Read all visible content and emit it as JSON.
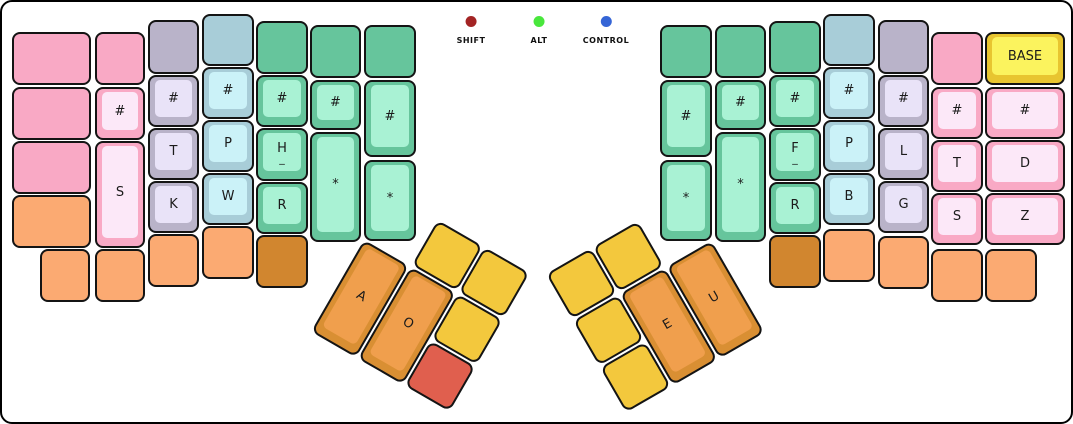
{
  "canvas": {
    "width": 1073,
    "height": 424
  },
  "legend": {
    "indicators": [
      {
        "label": "SHIFT",
        "color": "#a32424",
        "x": 469
      },
      {
        "label": "ALT",
        "color": "#49e73c",
        "x": 537
      },
      {
        "label": "CONTROL",
        "color": "#3565d6",
        "x": 604
      }
    ]
  },
  "palette": {
    "pink": {
      "base": "#f9a9c5",
      "top": "#fce8f8"
    },
    "gray": {
      "base": "#b9b3c9",
      "top": "#e9e3f8"
    },
    "blue": {
      "base": "#a8cdd8",
      "top": "#cbf2f8"
    },
    "green": {
      "base": "#66c59c",
      "top": "#a9f2d4"
    },
    "orange": {
      "base": "#fbaa72",
      "top": "#fbaa72"
    },
    "darkorange": {
      "base": "#d1862f",
      "top": "#d1862f"
    },
    "yellow": {
      "base": "#f3c83d",
      "top": "#f3c83d"
    },
    "red": {
      "base": "#e05f4e",
      "top": "#e05f4e"
    },
    "thumborange": {
      "base": "#d98f33",
      "top": "#f09f4d"
    },
    "basekey": {
      "base": "#e8c530",
      "top": "#fbf35e"
    }
  },
  "main_keys": [
    {
      "x": 10,
      "y": 30,
      "w": 79,
      "h": 53,
      "color": "pink",
      "label": ""
    },
    {
      "x": 10,
      "y": 85,
      "w": 79,
      "h": 53,
      "color": "pink",
      "label": ""
    },
    {
      "x": 10,
      "y": 139,
      "w": 79,
      "h": 53,
      "color": "pink",
      "label": ""
    },
    {
      "x": 10,
      "y": 193,
      "w": 79,
      "h": 53,
      "color": "orange",
      "label": ""
    },
    {
      "x": 38,
      "y": 247,
      "w": 50,
      "h": 53,
      "color": "orange",
      "label": ""
    },
    {
      "x": 93,
      "y": 30,
      "w": 50,
      "h": 53,
      "color": "pink",
      "label": ""
    },
    {
      "x": 93,
      "y": 85,
      "w": 50,
      "h": 53,
      "color": "pink",
      "label": "#"
    },
    {
      "x": 93,
      "y": 139,
      "w": 50,
      "h": 107,
      "color": "pink",
      "label": "S"
    },
    {
      "x": 93,
      "y": 247,
      "w": 50,
      "h": 53,
      "color": "orange",
      "label": ""
    },
    {
      "x": 146,
      "y": 18,
      "w": 51,
      "h": 54,
      "color": "gray",
      "label": ""
    },
    {
      "x": 146,
      "y": 73,
      "w": 51,
      "h": 52,
      "color": "gray",
      "label": "#"
    },
    {
      "x": 146,
      "y": 126,
      "w": 51,
      "h": 52,
      "color": "gray",
      "label": "T"
    },
    {
      "x": 146,
      "y": 179,
      "w": 51,
      "h": 52,
      "color": "gray",
      "label": "K"
    },
    {
      "x": 146,
      "y": 232,
      "w": 51,
      "h": 53,
      "color": "orange",
      "label": ""
    },
    {
      "x": 200,
      "y": 12,
      "w": 52,
      "h": 52,
      "color": "blue",
      "label": ""
    },
    {
      "x": 200,
      "y": 65,
      "w": 52,
      "h": 52,
      "color": "blue",
      "label": "#"
    },
    {
      "x": 200,
      "y": 118,
      "w": 52,
      "h": 52,
      "color": "blue",
      "label": "P"
    },
    {
      "x": 200,
      "y": 171,
      "w": 52,
      "h": 52,
      "color": "blue",
      "label": "W"
    },
    {
      "x": 200,
      "y": 224,
      "w": 52,
      "h": 53,
      "color": "orange",
      "label": ""
    },
    {
      "x": 254,
      "y": 19,
      "w": 52,
      "h": 53,
      "color": "green",
      "label": ""
    },
    {
      "x": 254,
      "y": 73,
      "w": 52,
      "h": 52,
      "color": "green",
      "label": "#"
    },
    {
      "x": 254,
      "y": 126,
      "w": 52,
      "h": 53,
      "color": "green",
      "label": "H",
      "sub": "_"
    },
    {
      "x": 254,
      "y": 180,
      "w": 52,
      "h": 52,
      "color": "green",
      "label": "R"
    },
    {
      "x": 254,
      "y": 233,
      "w": 52,
      "h": 53,
      "color": "darkorange",
      "label": ""
    },
    {
      "x": 308,
      "y": 23,
      "w": 51,
      "h": 53,
      "color": "green",
      "label": ""
    },
    {
      "x": 308,
      "y": 78,
      "w": 51,
      "h": 50,
      "color": "green",
      "label": "#"
    },
    {
      "x": 308,
      "y": 130,
      "w": 51,
      "h": 110,
      "color": "green",
      "label": "*"
    },
    {
      "x": 362,
      "y": 23,
      "w": 52,
      "h": 53,
      "color": "green",
      "label": ""
    },
    {
      "x": 362,
      "y": 78,
      "w": 52,
      "h": 77,
      "color": "green",
      "label": "#"
    },
    {
      "x": 362,
      "y": 158,
      "w": 52,
      "h": 81,
      "color": "green",
      "label": "*"
    },
    {
      "x": 658,
      "y": 23,
      "w": 52,
      "h": 53,
      "color": "green",
      "label": ""
    },
    {
      "x": 658,
      "y": 78,
      "w": 52,
      "h": 77,
      "color": "green",
      "label": "#"
    },
    {
      "x": 658,
      "y": 158,
      "w": 52,
      "h": 81,
      "color": "green",
      "label": "*"
    },
    {
      "x": 713,
      "y": 23,
      "w": 51,
      "h": 53,
      "color": "green",
      "label": ""
    },
    {
      "x": 713,
      "y": 78,
      "w": 51,
      "h": 50,
      "color": "green",
      "label": "#"
    },
    {
      "x": 713,
      "y": 130,
      "w": 51,
      "h": 110,
      "color": "green",
      "label": "*"
    },
    {
      "x": 767,
      "y": 19,
      "w": 52,
      "h": 53,
      "color": "green",
      "label": ""
    },
    {
      "x": 767,
      "y": 73,
      "w": 52,
      "h": 52,
      "color": "green",
      "label": "#"
    },
    {
      "x": 767,
      "y": 126,
      "w": 52,
      "h": 53,
      "color": "green",
      "label": "F",
      "sub": "_"
    },
    {
      "x": 767,
      "y": 180,
      "w": 52,
      "h": 52,
      "color": "green",
      "label": "R"
    },
    {
      "x": 767,
      "y": 233,
      "w": 52,
      "h": 53,
      "color": "darkorange",
      "label": ""
    },
    {
      "x": 821,
      "y": 12,
      "w": 52,
      "h": 52,
      "color": "blue",
      "label": ""
    },
    {
      "x": 821,
      "y": 65,
      "w": 52,
      "h": 52,
      "color": "blue",
      "label": "#"
    },
    {
      "x": 821,
      "y": 118,
      "w": 52,
      "h": 52,
      "color": "blue",
      "label": "P"
    },
    {
      "x": 821,
      "y": 171,
      "w": 52,
      "h": 52,
      "color": "blue",
      "label": "B"
    },
    {
      "x": 821,
      "y": 227,
      "w": 52,
      "h": 53,
      "color": "orange",
      "label": ""
    },
    {
      "x": 876,
      "y": 18,
      "w": 51,
      "h": 54,
      "color": "gray",
      "label": ""
    },
    {
      "x": 876,
      "y": 73,
      "w": 51,
      "h": 52,
      "color": "gray",
      "label": "#"
    },
    {
      "x": 876,
      "y": 126,
      "w": 51,
      "h": 52,
      "color": "gray",
      "label": "L"
    },
    {
      "x": 876,
      "y": 179,
      "w": 51,
      "h": 52,
      "color": "gray",
      "label": "G"
    },
    {
      "x": 876,
      "y": 234,
      "w": 51,
      "h": 53,
      "color": "orange",
      "label": ""
    },
    {
      "x": 929,
      "y": 30,
      "w": 52,
      "h": 53,
      "color": "pink",
      "label": ""
    },
    {
      "x": 929,
      "y": 85,
      "w": 52,
      "h": 52,
      "color": "pink",
      "label": "#"
    },
    {
      "x": 929,
      "y": 138,
      "w": 52,
      "h": 52,
      "color": "pink",
      "label": "T"
    },
    {
      "x": 929,
      "y": 191,
      "w": 52,
      "h": 52,
      "color": "pink",
      "label": "S"
    },
    {
      "x": 929,
      "y": 247,
      "w": 52,
      "h": 53,
      "color": "orange",
      "label": ""
    },
    {
      "x": 983,
      "y": 30,
      "w": 80,
      "h": 53,
      "color": "basekey",
      "label": "BASE"
    },
    {
      "x": 983,
      "y": 85,
      "w": 80,
      "h": 52,
      "color": "pink",
      "label": "#"
    },
    {
      "x": 983,
      "y": 138,
      "w": 80,
      "h": 52,
      "color": "pink",
      "label": "D"
    },
    {
      "x": 983,
      "y": 191,
      "w": 80,
      "h": 52,
      "color": "pink",
      "label": "Z"
    },
    {
      "x": 983,
      "y": 247,
      "w": 52,
      "h": 53,
      "color": "orange",
      "label": ""
    }
  ],
  "thumb_clusters": [
    {
      "name": "left-thumb-cluster",
      "x": 389,
      "y": 191,
      "rotation_deg": 30,
      "keys": [
        {
          "x": 54,
          "y": 0,
          "w": 52,
          "h": 52,
          "color": "yellow",
          "label": ""
        },
        {
          "x": 108,
          "y": 0,
          "w": 52,
          "h": 52,
          "color": "yellow",
          "label": ""
        },
        {
          "x": 0,
          "y": 54,
          "w": 52,
          "h": 106,
          "color": "thumborange",
          "label": "A"
        },
        {
          "x": 54,
          "y": 54,
          "w": 52,
          "h": 106,
          "color": "thumborange",
          "label": "O"
        },
        {
          "x": 108,
          "y": 54,
          "w": 52,
          "h": 52,
          "color": "yellow",
          "label": ""
        },
        {
          "x": 108,
          "y": 108,
          "w": 52,
          "h": 52,
          "color": "red",
          "label": ""
        }
      ]
    },
    {
      "name": "right-thumb-cluster",
      "x": 544,
      "y": 272,
      "rotation_deg": -30,
      "keys": [
        {
          "x": 0,
          "y": 0,
          "w": 52,
          "h": 52,
          "color": "yellow",
          "label": ""
        },
        {
          "x": 54,
          "y": 0,
          "w": 52,
          "h": 52,
          "color": "yellow",
          "label": ""
        },
        {
          "x": 0,
          "y": 54,
          "w": 52,
          "h": 52,
          "color": "yellow",
          "label": ""
        },
        {
          "x": 0,
          "y": 108,
          "w": 52,
          "h": 52,
          "color": "yellow",
          "label": ""
        },
        {
          "x": 54,
          "y": 54,
          "w": 52,
          "h": 106,
          "color": "thumborange",
          "label": "E"
        },
        {
          "x": 108,
          "y": 54,
          "w": 52,
          "h": 106,
          "color": "thumborange",
          "label": "U"
        }
      ]
    }
  ]
}
